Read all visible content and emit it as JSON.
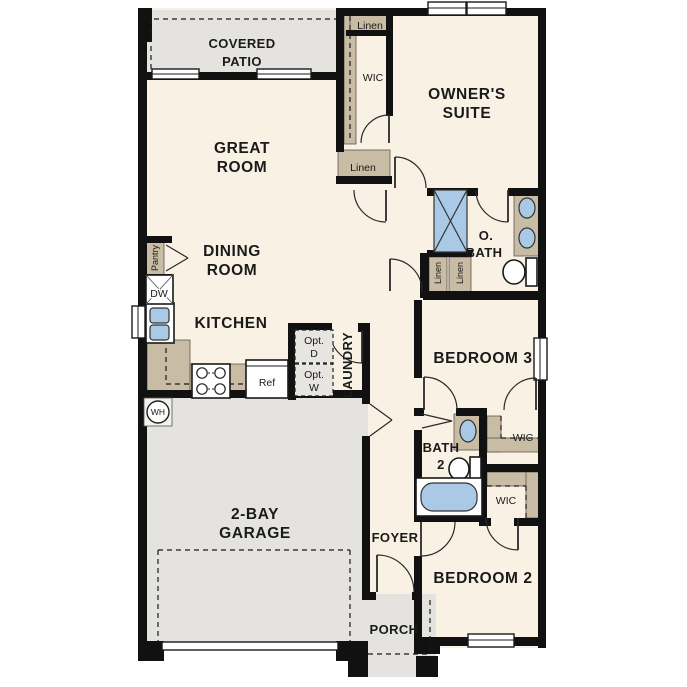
{
  "floor_plan": {
    "rooms": {
      "covered_patio": {
        "line1": "COVERED",
        "line2": "PATIO"
      },
      "great_room": {
        "line1": "GREAT",
        "line2": "ROOM"
      },
      "dining_room": {
        "line1": "DINING",
        "line2": "ROOM"
      },
      "kitchen": {
        "label": "KITCHEN"
      },
      "owners_suite": {
        "line1": "OWNER'S",
        "line2": "SUITE"
      },
      "owners_bath": {
        "line1": "O.",
        "line2": "BATH"
      },
      "laundry": {
        "label": "LAUNDRY"
      },
      "garage": {
        "line1": "2-BAY",
        "line2": "GARAGE"
      },
      "bedroom3": {
        "label": "BEDROOM 3"
      },
      "bath2": {
        "line1": "BATH",
        "line2": "2"
      },
      "bedroom2": {
        "label": "BEDROOM 2"
      },
      "foyer": {
        "label": "FOYER"
      },
      "porch": {
        "label": "PORCH"
      }
    },
    "closets": {
      "linen_top": "Linen",
      "linen_mid": "Linen",
      "linen_hall_a": "Linen",
      "linen_hall_b": "Linen",
      "pantry": "Pantry",
      "owners_wic": "WIC",
      "bedroom3_wic": "WIC",
      "bedroom2_wic": "WIC"
    },
    "appliances": {
      "dishwasher": "DW",
      "refrigerator": "Ref",
      "water_heater": "WH",
      "optional_dryer": {
        "line1": "Opt.",
        "line2": "D"
      },
      "optional_washer": {
        "line1": "Opt.",
        "line2": "W"
      }
    },
    "colors": {
      "background": "#ffffff",
      "interior": "#f8f1e4",
      "exterior_concrete": "#e4e3e0",
      "cabinetry": "#c9bca4",
      "fixtures_blue": "#aac9e7",
      "walls": "#111111"
    }
  }
}
